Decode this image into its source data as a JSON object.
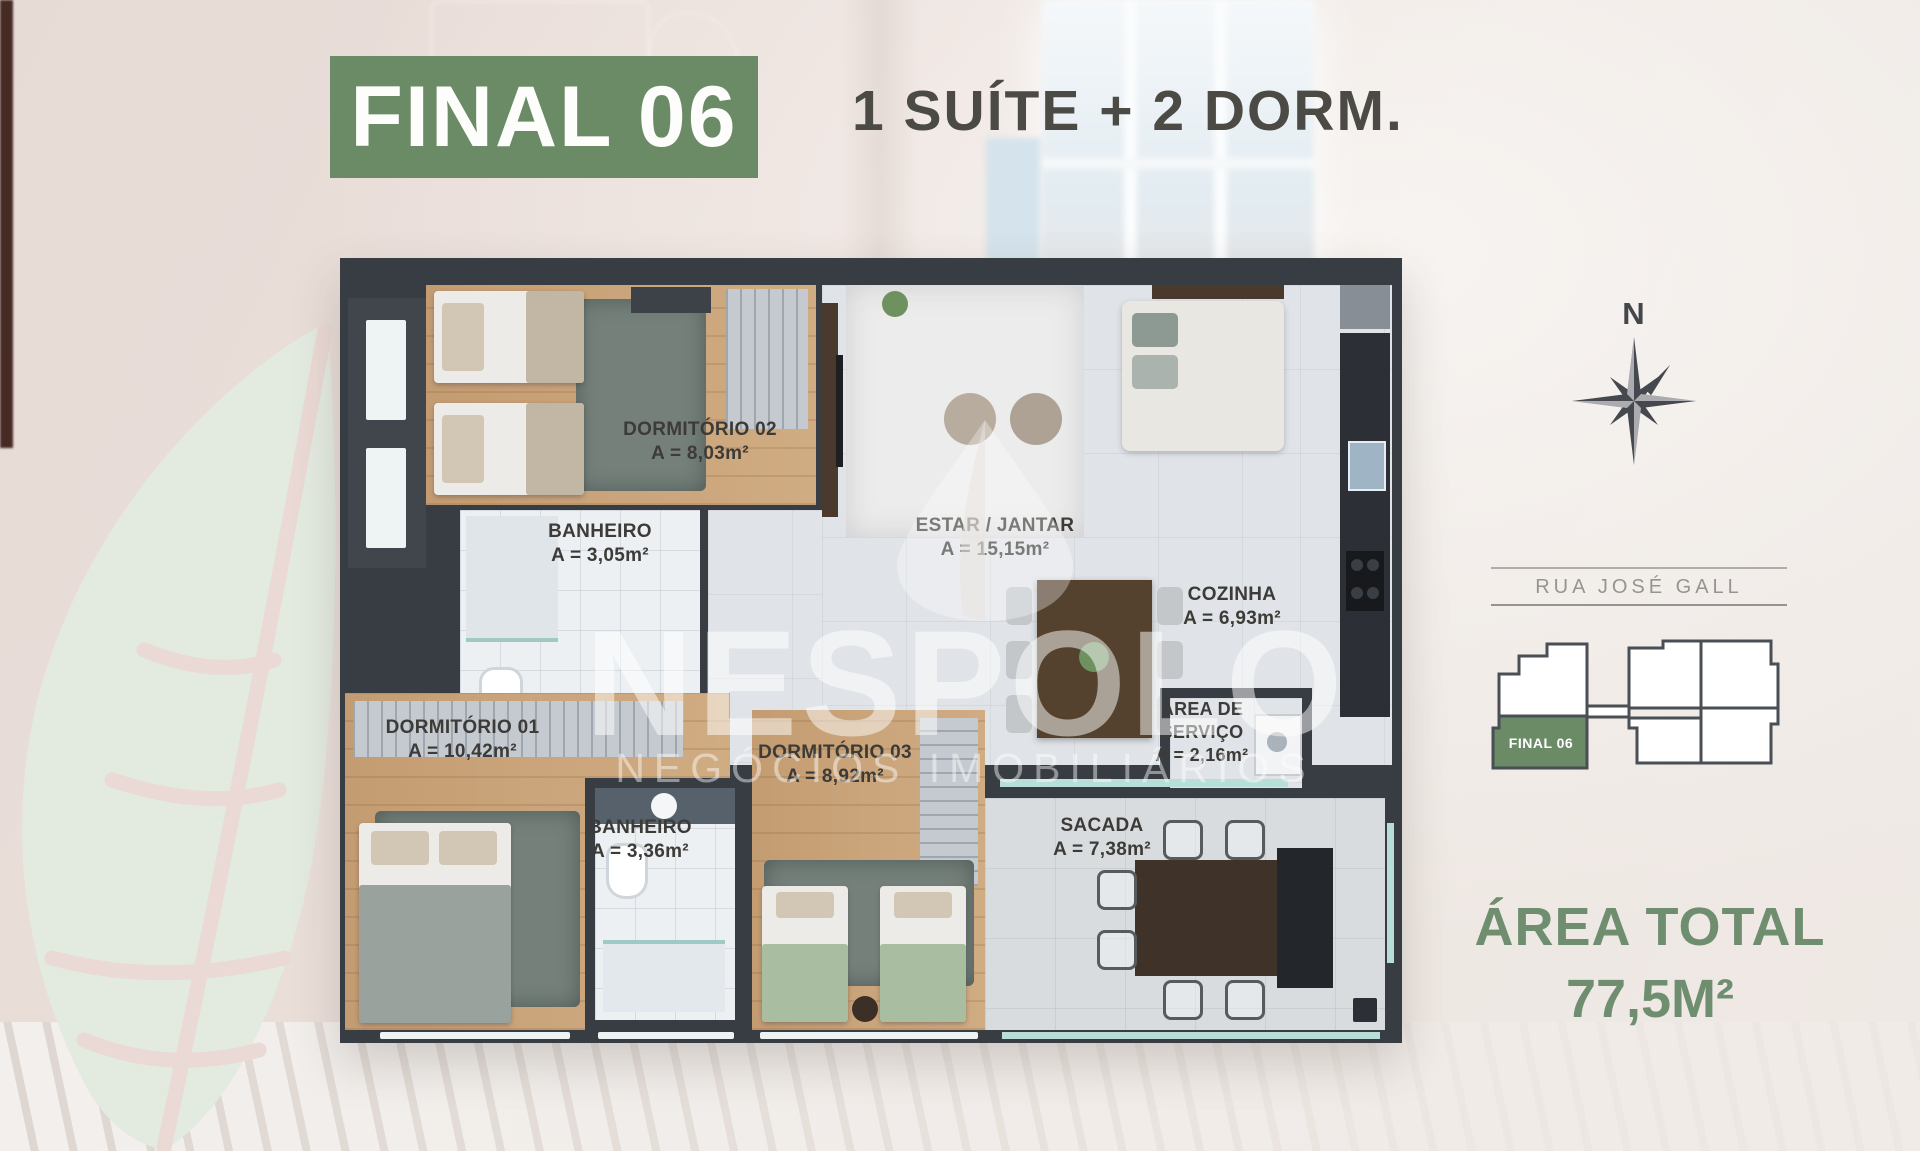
{
  "header": {
    "badge": "FINAL 06",
    "subtitle": "1 SUÍTE + 2 DORM."
  },
  "plan": {
    "rooms": [
      {
        "key": "dormitorio-02",
        "name": "DORMITÓRIO 02",
        "area": "A = 8,03m²"
      },
      {
        "key": "banheiro-social",
        "name": "BANHEIRO",
        "area": "A = 3,05m²"
      },
      {
        "key": "estar-jantar",
        "name": "ESTAR / JANTAR",
        "area": "A = 15,15m²"
      },
      {
        "key": "cozinha",
        "name": "COZINHA",
        "area": "A = 6,93m²"
      },
      {
        "key": "area-de-servico",
        "name": "ÁREA DE SERVIÇO",
        "area": "A = 2,16m²"
      },
      {
        "key": "dormitorio-01",
        "name": "DORMITÓRIO 01",
        "area": "A = 10,42m²"
      },
      {
        "key": "banheiro-suite",
        "name": "BANHEIRO",
        "area": "A = 3,36m²"
      },
      {
        "key": "dormitorio-03",
        "name": "DORMITÓRIO 03",
        "area": "A = 8,92m²"
      },
      {
        "key": "sacada",
        "name": "SACADA",
        "area": "A = 7,38m²"
      }
    ]
  },
  "compass": {
    "north_label": "N"
  },
  "keyplan": {
    "street": "RUA JOSÉ GALL",
    "unit_label": "FINAL 06"
  },
  "totals": {
    "label": "ÁREA TOTAL",
    "value": "77,5M²"
  },
  "watermark": {
    "brand": "NESPOLO",
    "tagline": "NEGÓCIOS IMOBILIÁRIOS"
  },
  "colors": {
    "brand_green": "#6b8a66",
    "total_green": "#6f8e6f",
    "subtitle_gray": "#4b4a44",
    "wall_dark": "#383c43",
    "wood_floor": "#c9a378",
    "leaf_green": "#e3eae0"
  }
}
